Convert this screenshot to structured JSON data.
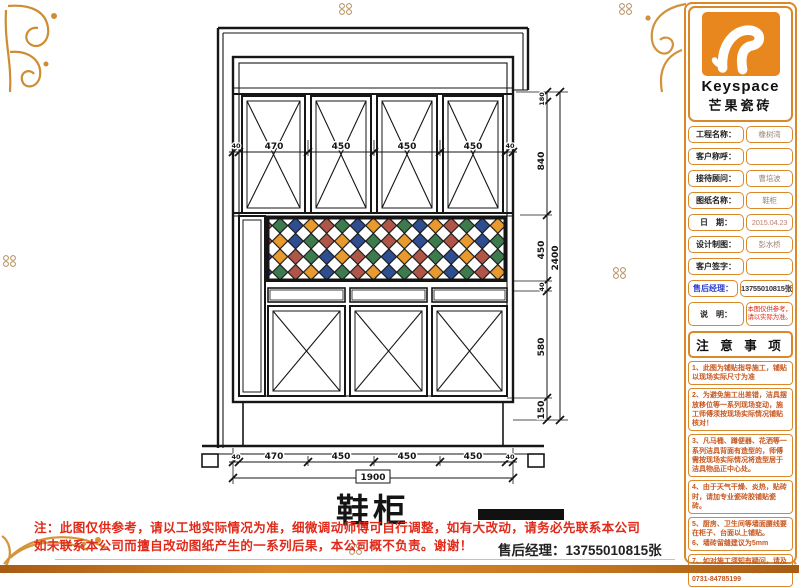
{
  "logo": {
    "brand": "Keyspace",
    "subbrand": "芒果瓷砖"
  },
  "info_table": {
    "rows": [
      {
        "label": "工程名称：",
        "value": "橡树湾"
      },
      {
        "label": "客户称呼：",
        "value": ""
      },
      {
        "label": "接待顾问：",
        "value": "曹培波"
      },
      {
        "label": "图纸名称：",
        "value": "鞋柜"
      },
      {
        "label": "日　期：",
        "value": "2015.04.23"
      },
      {
        "label": "设计制图：",
        "value": "彭水桥"
      },
      {
        "label": "客户签字：",
        "value": ""
      },
      {
        "label": "售后经理：",
        "value": "13755010815张"
      },
      {
        "label": "说　明：",
        "value": "本图仅供参考，请以实际为准。"
      }
    ]
  },
  "notes": {
    "title": "注 意 事 项",
    "items": [
      "1、此图为铺贴指导施工，铺贴以现场实际尺寸为准",
      "2、为避免施工出差错，洁具摆放移位等一系列现场变动，施工师傅须按现场实际情况铺贴核对！",
      "3、凡马桶、蹲便器、花洒等一系列洁具背面有造型的，师傅需按现场实际情况将造型居于洁具物品正中心处。",
      "4、由于天气干燥、炎热，贴砖时，请加专业瓷砖胶铺贴瓷砖。",
      "5、厨房、卫生间等墙面腰线要在柜子、台面以上铺贴。",
      "6、墙砖留缝建议为5mm",
      "7、如对施工须知有疑问，请及时联系本公司。公司电话：0731-84785199"
    ]
  },
  "footer": {
    "line1": "注：此图仅供参考，请以工地实际情况为准，细微调动师傅可自行调整，如有大改动，请务必先联系本公司",
    "line2": "如未联系本公司而擅自改动图纸产生的一系列后果，本公司概不负责。谢谢！",
    "manager": "售后经理：13755010815张"
  },
  "drawing": {
    "title": "鞋柜",
    "dims_top": [
      "40",
      "470",
      "450",
      "450",
      "450",
      "40"
    ],
    "dims_bottom": [
      "40",
      "470",
      "450",
      "450",
      "450",
      "40"
    ],
    "dims_bottom_total": "1900",
    "dims_right": [
      "180",
      "840",
      "450",
      "40",
      "580",
      "150"
    ],
    "dims_right_total": "2400",
    "mosaic": {
      "palette": [
        "#3d7a4d",
        "#2e4e8f",
        "#e89a2f",
        "#b05648"
      ],
      "white": "#ffffff"
    }
  },
  "colors": {
    "accent_orange": "#d9882a",
    "warning_red": "#e02a1a",
    "note_orange": "#c7571f"
  }
}
